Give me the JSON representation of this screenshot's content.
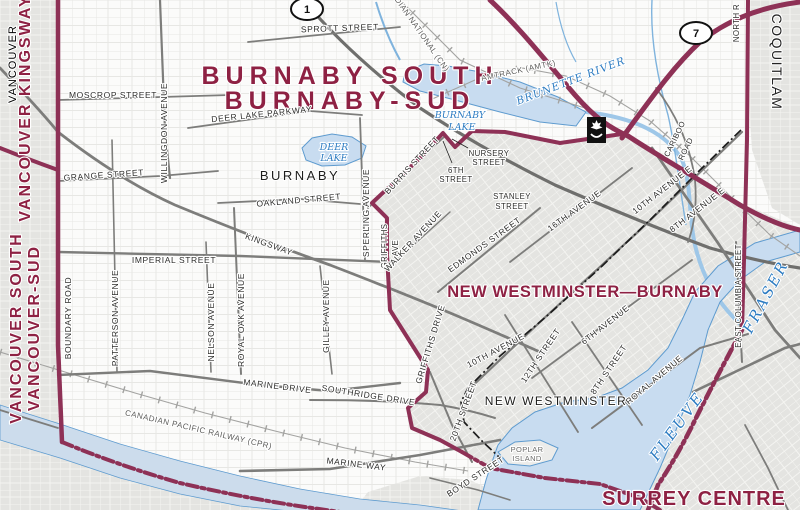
{
  "title": {
    "line1": "BURNABY SOUTH",
    "line2": "BURNABY-SUD"
  },
  "districts": {
    "new_westminster_burnaby": "NEW WESTMINSTER—BURNABY",
    "surrey_centre": "SURREY CENTRE",
    "vancouver_kingsway": "VANCOUVER KINGSWAY",
    "vancouver_south_en": "VANCOUVER SOUTH",
    "vancouver_south_fr": "VANCOUVER-SUD"
  },
  "municipalities": {
    "burnaby": "BURNABY",
    "new_westminster": "NEW WESTMINSTER",
    "vancouver": "VANCOUVER",
    "coquitlam": "COQUITLAM"
  },
  "water": {
    "deer_lake_1": "DEER",
    "deer_lake_2": "LAKE",
    "burnaby_lake_1": "BURNABY",
    "burnaby_lake_2": "LAKE",
    "brunette_river": "BRUNETTE RIVER",
    "fraser": "FRASER",
    "fleuve": "FLEUVE",
    "poplar_island_1": "POPLAR",
    "poplar_island_2": "ISLAND"
  },
  "railways": {
    "cn": "CANADIAN NATIONAL (CN)",
    "amtrak": "AMTRACK (AMTK)",
    "cpr": "CANADIAN PACIFIC RAILWAY (CPR)"
  },
  "highway_shields": {
    "shield_1": "1",
    "shield_7": "7"
  },
  "streets": {
    "sprott": "SPROTT STREET",
    "moscrop": "MOSCROP STREET",
    "deer_lake_pkwy": "DEER LAKE PARKWAY",
    "grange": "GRANGE STREET",
    "oakland": "OAKLAND STREET",
    "imperial": "IMPERIAL STREET",
    "kingsway": "KINGSWAY",
    "marine_drive": "MARINE DRIVE",
    "southridge": "SOUTHRIDGE DRIVE",
    "marine_way": "MARINE WAY",
    "willingdon": "WILLINGDON AVENUE",
    "boundary": "BOUNDARY ROAD",
    "patterson": "PATTERSON AVENUE",
    "nelson": "NELSON AVENUE",
    "royal_oak": "ROYAL OAK AVENUE",
    "gilley": "GILLEY AVENUE",
    "sperling": "SPERLING AVENUE",
    "burris": "BURRIS STREET",
    "stanley_1": "STANLEY",
    "stanley_2": "STREET",
    "walker": "WALKER AVENUE",
    "griffiths_1": "GRIFFITHS",
    "griffiths_2": "AVE",
    "griffiths_drive": "GRIFFITHS DRIVE",
    "twentieth": "20TH STREET",
    "edmonds": "EDMONDS STREET",
    "sixteenth_ave": "16TH AVENUE",
    "tenth_ave_e": "10TH AVENUE E",
    "eighth_ave_e": "8TH AVENUE E",
    "cariboo_1": "CARIBOO",
    "cariboo_2": "ROAD",
    "east_columbia": "EAST COLUMBIA STREET",
    "north_road": "NORTH R",
    "nursery_1": "NURSERY",
    "nursery_2": "STREET",
    "sixth_st_nw_1": "6TH",
    "sixth_st_nw_2": "STREET",
    "tenth_ave": "10TH AVENUE",
    "twelfth_st": "12TH STREET",
    "sixth_ave": "6TH AVENUE",
    "eighth_st": "8TH STREET",
    "royal_ave": "ROYAL AVENUE",
    "boyd": "BOYD STREET"
  },
  "icons": {
    "federal_institution": "federal-institution",
    "hwy1_shield": "highway-1-shield",
    "hwy7_shield": "highway-7-shield"
  },
  "colors": {
    "district_maroon_text": "#8e2143",
    "boundary_maroon": "#8e3156",
    "water_fill": "#c8dcf0",
    "water_stroke": "#5e9bcf",
    "water_label": "#2d7cc2",
    "urban_gray": "#e4e4e1",
    "road_gray": "#7d7d7b"
  }
}
